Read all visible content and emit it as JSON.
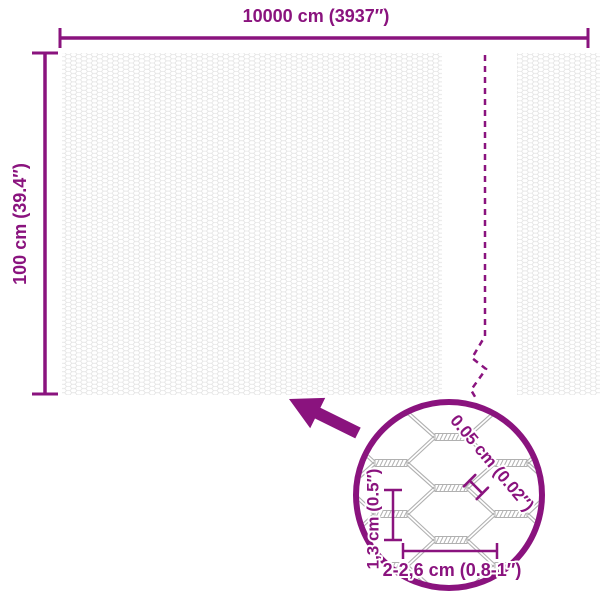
{
  "diagram": {
    "width_label": "10000 cm (3937″)",
    "height_label": "100 cm (39.4″)",
    "detail": {
      "wire_thickness_label": "0.05 cm (0.02″)",
      "cell_height_label": "1,3 cm (0.5″)",
      "cell_width_label": "2-2,6 cm (0.8-1″)"
    },
    "colors": {
      "accent": "#8A137E",
      "wire_gray": "#B0B0B0",
      "texture_gray": "#E4E4E4"
    }
  }
}
